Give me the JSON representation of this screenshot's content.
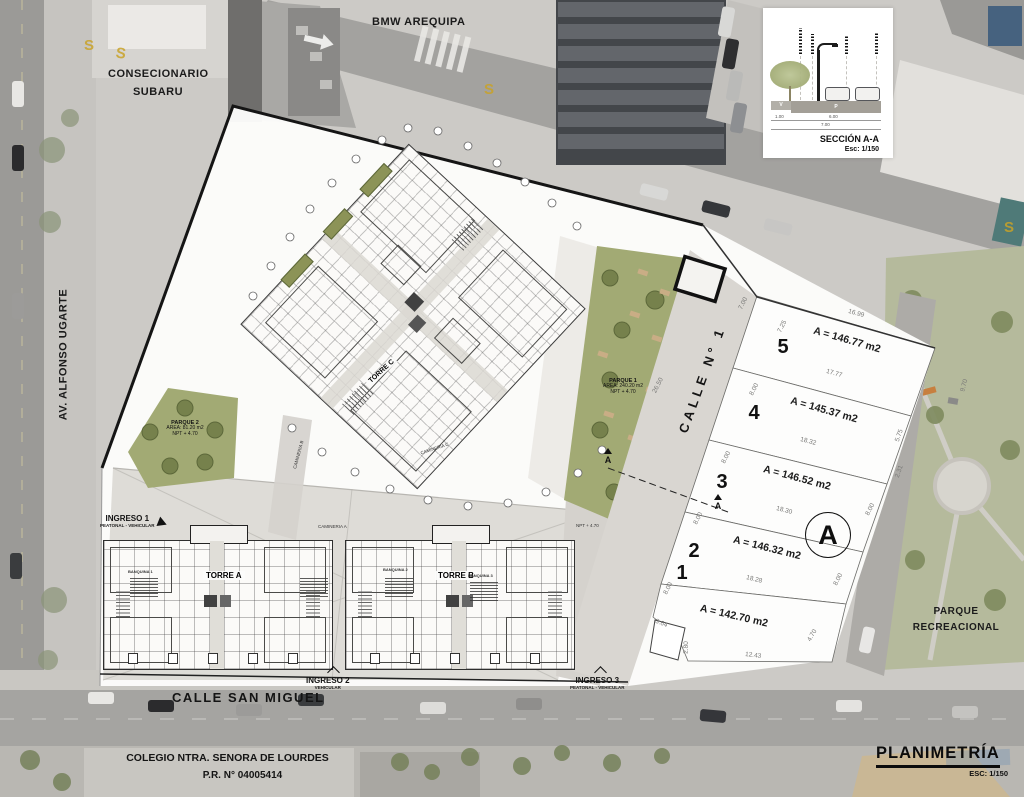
{
  "title_block": {
    "title": "PLANIMETRÍA",
    "scale": "ESC: 1/150"
  },
  "streets": {
    "bmw": "BMW AREQUIPA",
    "dealer_line1": "CONSECIONARIO",
    "dealer_line2": "SUBARU",
    "avenue": "AV. ALFONSO UGARTE",
    "san_miguel": "CALLE SAN MIGUEL",
    "calle1": "CALLE N° 1",
    "school_line1": "COLEGIO NTRA. SENORA DE LOURDES",
    "school_line2": "P.R. N° 04005414",
    "park_line1": "PARQUE",
    "park_line2": "RECREACIONAL",
    "road_mark": "S"
  },
  "section_inset": {
    "title": "SECCIÓN A-A",
    "scale": "Esc: 1/150",
    "dim_left": "1.00",
    "dim_right": "6.00",
    "dim_total": "7.00",
    "lane_v": "V",
    "lane_p": "P"
  },
  "entrances": {
    "i1_name": "INGRESO 1",
    "i1_type": "PEATONAL - VEHICULAR",
    "i2_name": "INGRESO 2",
    "i2_type": "VEHICULAR",
    "i3_name": "INGRESO 3",
    "i3_type": "PEATONAL - VEHICULAR"
  },
  "buildings": {
    "torre_a": "TORRE A",
    "torre_b": "TORRE B",
    "torre_c": "TORRE C",
    "banquina1": "BANQUINA 1",
    "banquina2": "BANQUINA 2",
    "banquina3": "BANQUINA 3",
    "camineria_a": "CAMINERIA A",
    "camineria_b": "CAMINERIA B",
    "camineria_c": "CAMINERIA C",
    "npt": "NPT + 4.70"
  },
  "parks": {
    "p1_name": "PARQUE 1",
    "p1_area": "AREA: 240.20 m2",
    "p1_npt": "NPT + 4.70",
    "p2_name": "PARQUE 2",
    "p2_area": "AREA: 81.20 m2",
    "p2_npt": "NPT + 4.70"
  },
  "lots": [
    {
      "num": "5",
      "area": "A = 146.77 m2"
    },
    {
      "num": "4",
      "area": "A = 145.37 m2"
    },
    {
      "num": "3",
      "area": "A = 146.52 m2"
    },
    {
      "num": "2",
      "area": "A = 146.32 m2"
    },
    {
      "num": "1",
      "area": "A = 142.70 m2"
    }
  ],
  "section_marker": "A",
  "dims": [
    "7.00",
    "7.25",
    "16.99",
    "17.77",
    "8.00",
    "18.32",
    "5.75",
    "9.70",
    "8.00",
    "2.31",
    "18.30",
    "8.00",
    "8.00",
    "18.28",
    "8.00",
    "8.00",
    "3.64",
    "4.70",
    "2.80",
    "12.43",
    "26.50"
  ],
  "colors": {
    "plan_green": "#a2aa74",
    "road_mark_yellow": "#c9a227",
    "boundary_black": "#151515"
  }
}
